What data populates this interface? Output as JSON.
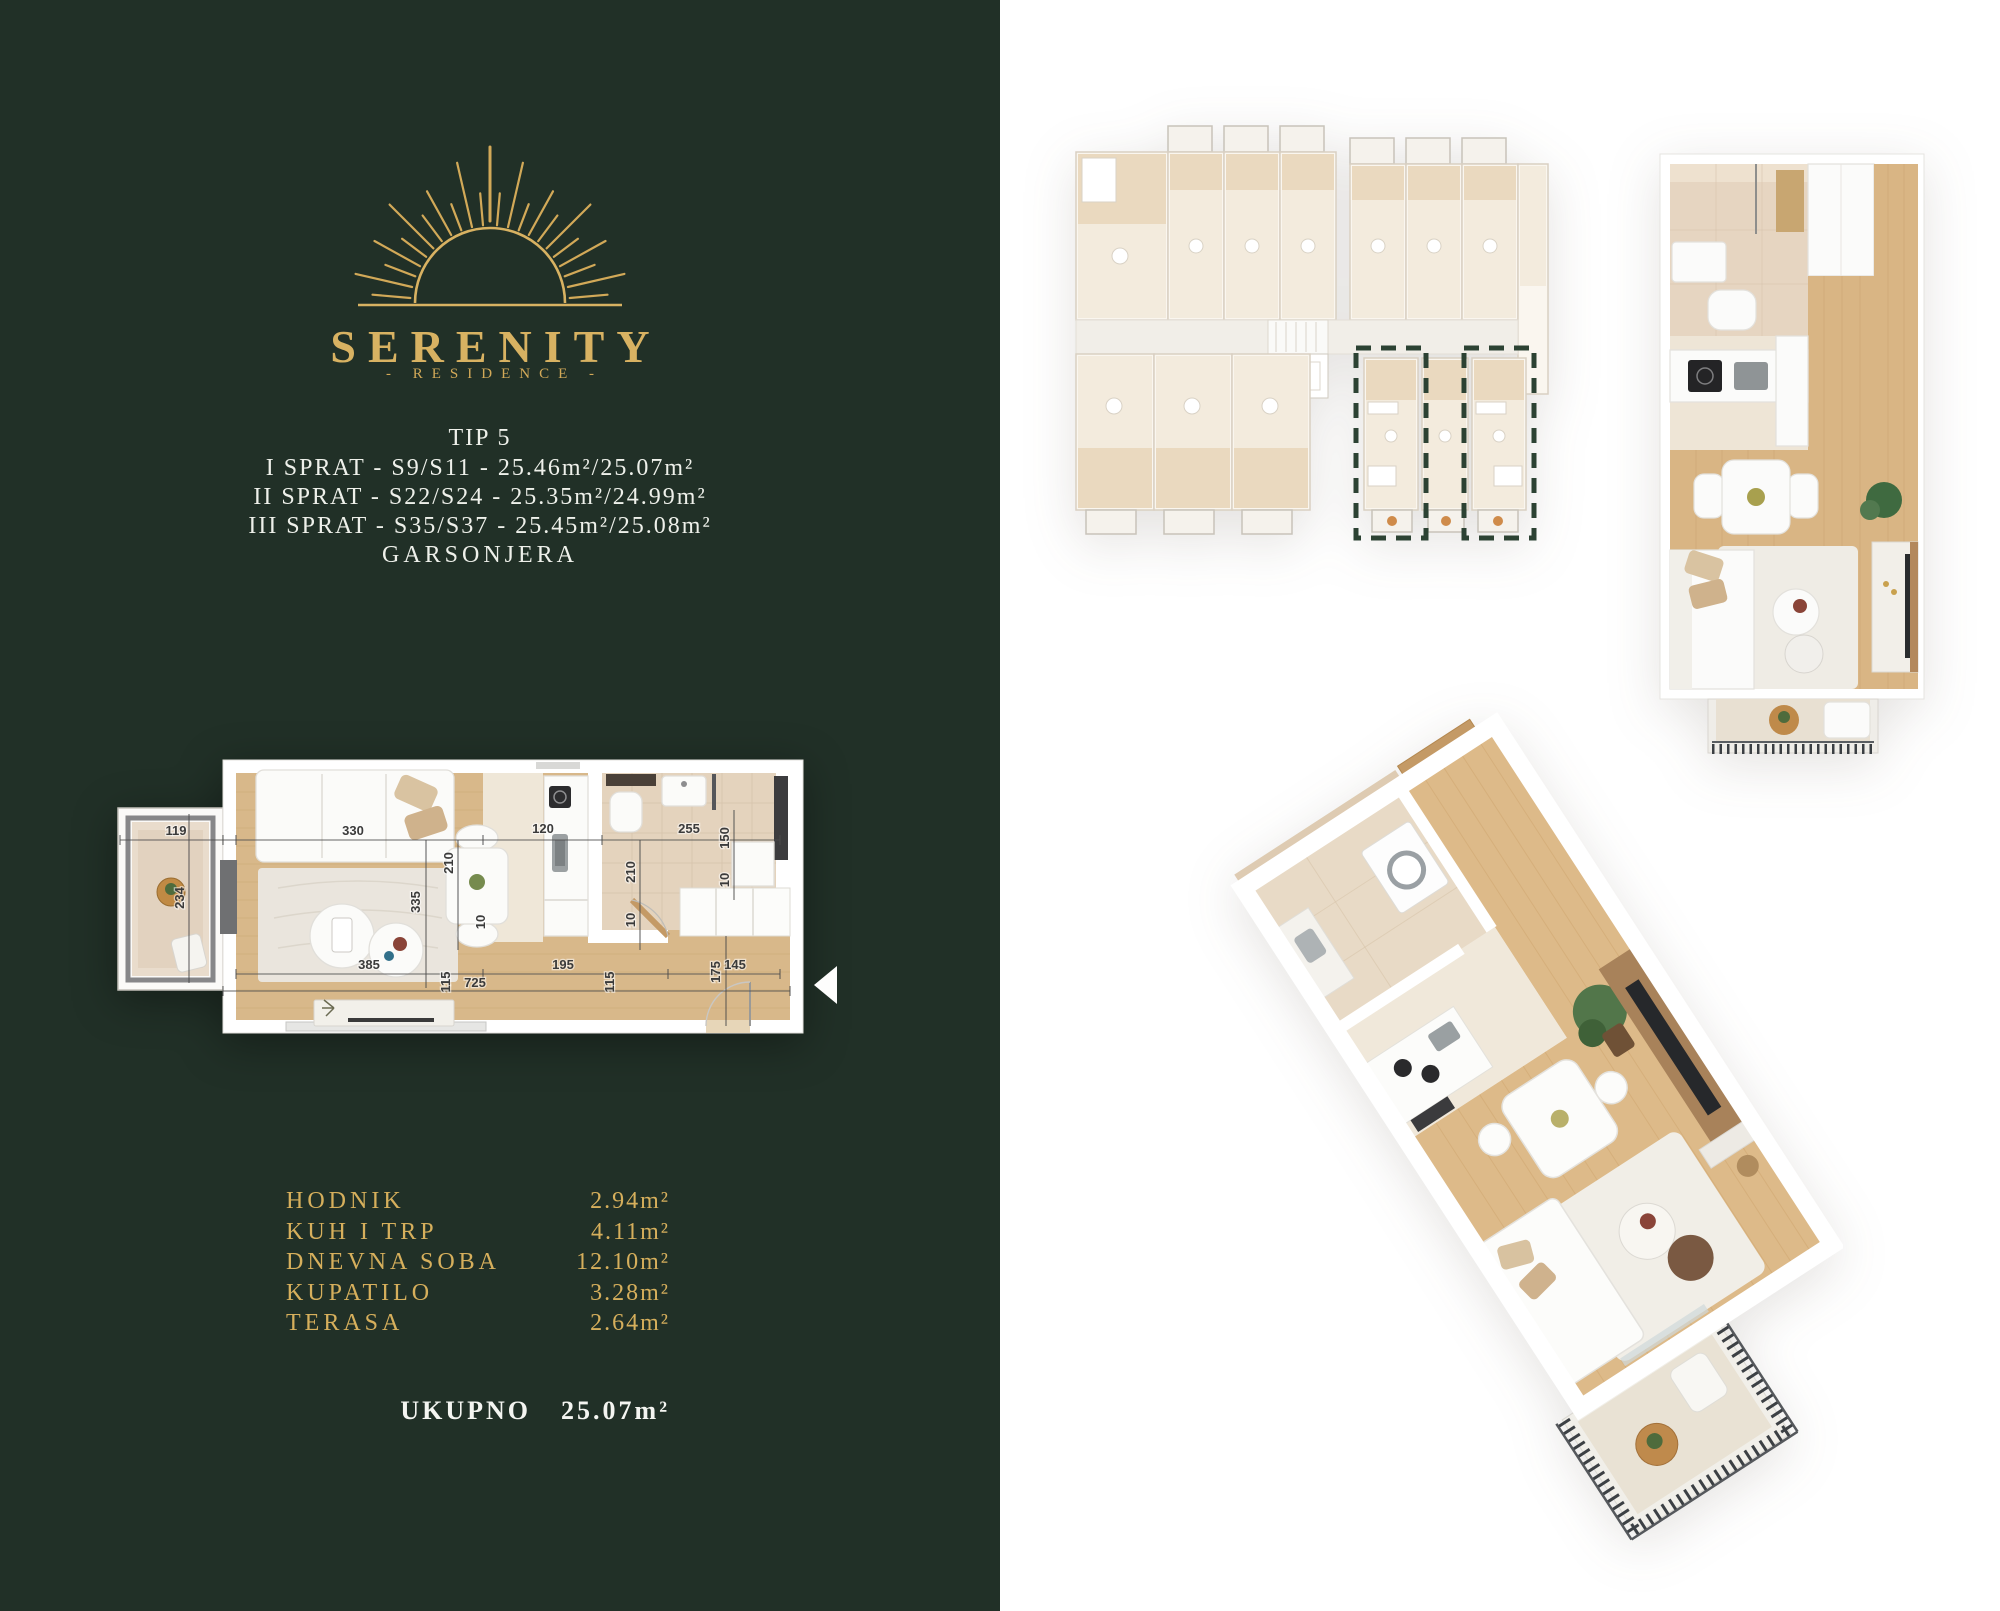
{
  "brand": {
    "name": "SERENITY",
    "tagline": "- RESIDENCE -"
  },
  "unit": {
    "title": "TIP 5",
    "lines": [
      "I SPRAT - S9/S11 - 25.46m²/25.07m²",
      "II SPRAT - S22/S24 - 25.35m²/24.99m²",
      "III SPRAT - S35/S37 - 25.45m²/25.08m²"
    ],
    "type_label": "GARSONJERA"
  },
  "areas": {
    "rows": [
      {
        "label": "HODNIK",
        "value": "2.94m²"
      },
      {
        "label": "KUH I TRP",
        "value": "4.11m²"
      },
      {
        "label": "DNEVNA SOBA",
        "value": "12.10m²"
      },
      {
        "label": "KUPATILO",
        "value": "3.28m²"
      },
      {
        "label": "TERASA",
        "value": "2.64m²"
      }
    ],
    "total_label": "UKUPNO",
    "total_value": "25.07m²"
  },
  "floorplan": {
    "dims": {
      "terrace_w": "119",
      "terrace_h": "234",
      "living_w": "330",
      "kitchen_w": "120",
      "bath_w": "255",
      "dining_h": "210",
      "living_h": "335",
      "bath_h": "210",
      "shaft_h": "150",
      "wall_top": "10",
      "wall_mid": "10",
      "wall_low": "10",
      "living_b": "385",
      "wall_left_b": "115",
      "total_b": "725",
      "hall_b": "195",
      "wall_right_b": "115",
      "entry_h": "175",
      "entry_b": "145"
    }
  },
  "icons": {
    "logo_icon": "sunrise-rays",
    "prev_arrow_icon": "triangle-left"
  },
  "colors": {
    "panel_green": "#213027",
    "gold": "#d2a958",
    "text_light": "#f2f4ee",
    "highlight_dash": "#2c4233",
    "wood_floor": "#d8b88a",
    "door_wood": "#c49a66"
  }
}
